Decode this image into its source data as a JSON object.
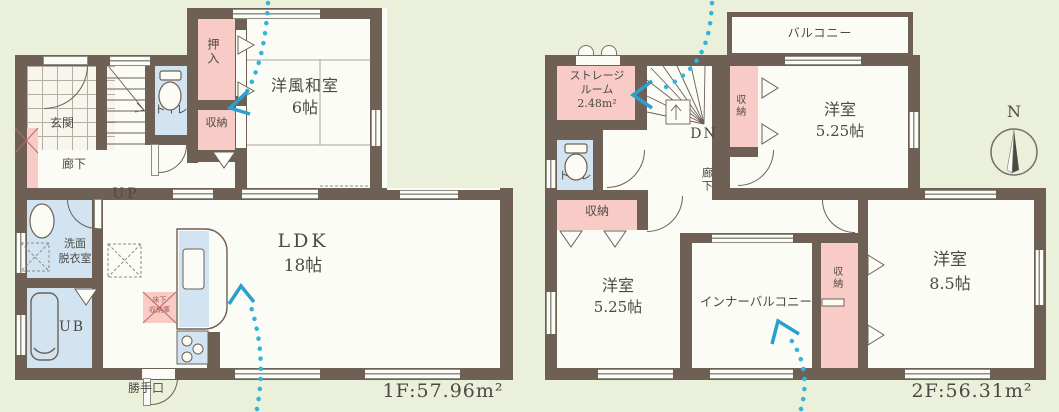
{
  "floor1": {
    "area_label": "1F:57.96m²",
    "labels": {
      "genkan": "玄関",
      "rouka": "廊下",
      "up": "UP",
      "toilet": "トイレ",
      "oshiire": "押入",
      "shuno": "収納",
      "washitsu": "洋風和室",
      "washitsu_size": "6帖",
      "senmen1": "洗面",
      "senmen2": "脱衣室",
      "ub": "UB",
      "ldk": "LDK",
      "ldk_size": "18帖",
      "yukashita1": "床下",
      "yukashita2": "収納庫",
      "katteguchi": "勝手口"
    }
  },
  "floor2": {
    "area_label": "2F:56.31m²",
    "labels": {
      "balcony": "バルコニー",
      "storage1": "ストレージ",
      "storage2": "ルーム",
      "storage_area": "2.48m²",
      "dn": "DN",
      "toilet": "トイレ",
      "rouka": "廊下",
      "shuno_hall": "収納",
      "yoshitsu_tr": "洋室",
      "yoshitsu_tr_size": "5.25帖",
      "shuno_tr": "収納",
      "yoshitsu_bl": "洋室",
      "yoshitsu_bl_size": "5.25帖",
      "inner_balcony": "インナーバルコニー",
      "shuno_col": "収納",
      "yoshitsu_br": "洋室",
      "yoshitsu_br_size": "8.5帖",
      "north": "N"
    }
  },
  "colors": {
    "background": "#eaf0d9",
    "wall": "#6e6055",
    "closet_pink": "#f8cbc6",
    "wet_area_blue": "#d2e4f1",
    "floor_white": "#fcfcf7",
    "flow_arrow_cyan": "#33b5da",
    "text": "#4c4a45"
  }
}
